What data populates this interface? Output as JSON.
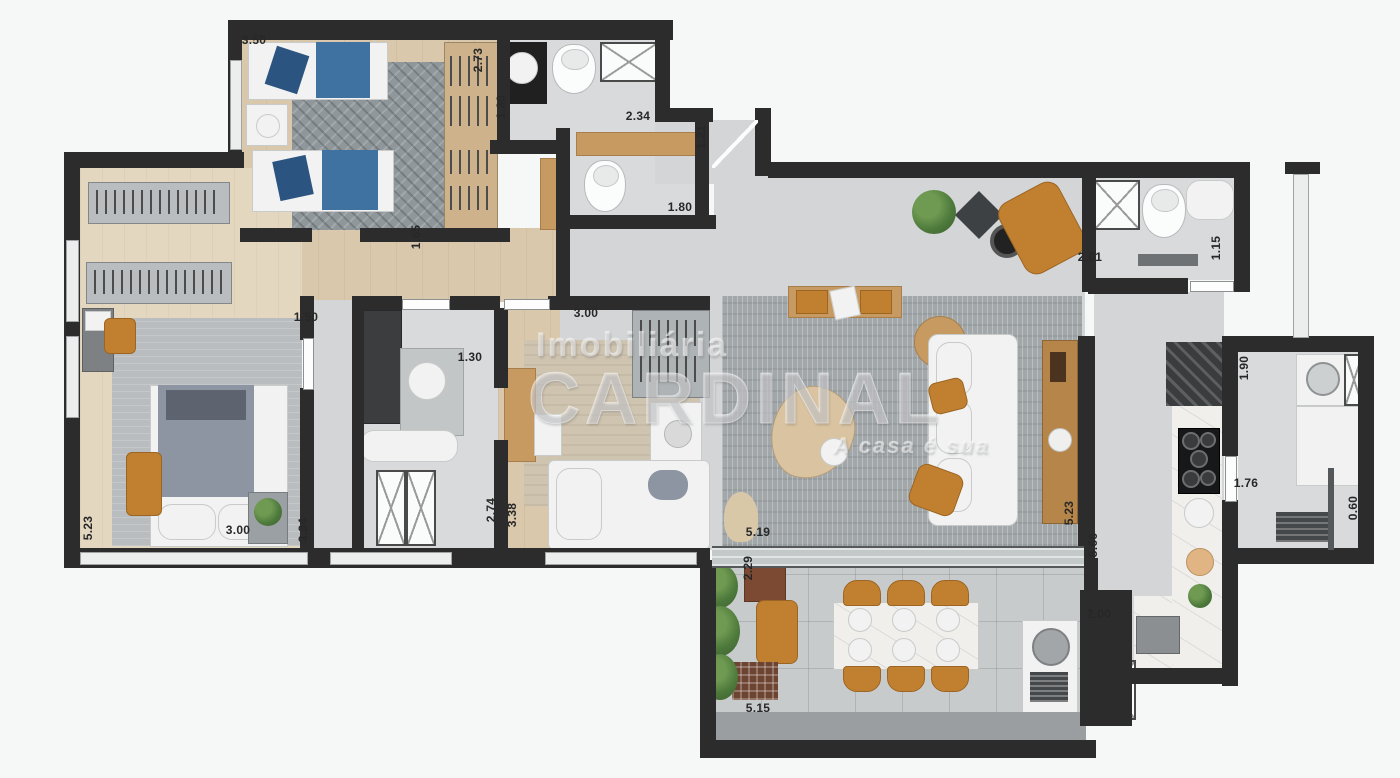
{
  "watermark": {
    "line1": "Imobiliária",
    "line2": "CARDINAL",
    "tagline": "A casa é sua"
  },
  "dimensions": [
    {
      "label": "3.50",
      "x": 236,
      "y": 33,
      "rot": 0
    },
    {
      "label": "2.73",
      "x": 460,
      "y": 53,
      "rot": -90
    },
    {
      "label": "1.30",
      "x": 483,
      "y": 100,
      "rot": -90
    },
    {
      "label": "2.34",
      "x": 620,
      "y": 109,
      "rot": 0
    },
    {
      "label": "1.21",
      "x": 683,
      "y": 130,
      "rot": -90
    },
    {
      "label": "1.80",
      "x": 662,
      "y": 200,
      "rot": 0
    },
    {
      "label": "1.65",
      "x": 398,
      "y": 230,
      "rot": -90
    },
    {
      "label": "2.01",
      "x": 1072,
      "y": 250,
      "rot": 0
    },
    {
      "label": "1.15",
      "x": 1198,
      "y": 241,
      "rot": -90
    },
    {
      "label": "1.50",
      "x": 288,
      "y": 310,
      "rot": 0
    },
    {
      "label": "3.00",
      "x": 568,
      "y": 306,
      "rot": 0
    },
    {
      "label": "1.30",
      "x": 452,
      "y": 350,
      "rot": 0
    },
    {
      "label": "1.90",
      "x": 1226,
      "y": 361,
      "rot": -90
    },
    {
      "label": "1.76",
      "x": 1228,
      "y": 476,
      "rot": 0
    },
    {
      "label": "0.60",
      "x": 1335,
      "y": 501,
      "rot": -90
    },
    {
      "label": "2.74",
      "x": 473,
      "y": 503,
      "rot": -90
    },
    {
      "label": "3.38",
      "x": 494,
      "y": 508,
      "rot": -90
    },
    {
      "label": "5.19",
      "x": 740,
      "y": 525,
      "rot": 0
    },
    {
      "label": "5.23",
      "x": 70,
      "y": 521,
      "rot": -90
    },
    {
      "label": "3.00",
      "x": 220,
      "y": 523,
      "rot": 0
    },
    {
      "label": "3.34",
      "x": 285,
      "y": 523,
      "rot": -90
    },
    {
      "label": "5.23",
      "x": 1051,
      "y": 506,
      "rot": -90
    },
    {
      "label": "5.66",
      "x": 1075,
      "y": 538,
      "rot": -90
    },
    {
      "label": "2.29",
      "x": 730,
      "y": 561,
      "rot": -90
    },
    {
      "label": "2.00",
      "x": 1081,
      "y": 607,
      "rot": 0
    },
    {
      "label": "5.15",
      "x": 740,
      "y": 701,
      "rot": 0
    }
  ]
}
